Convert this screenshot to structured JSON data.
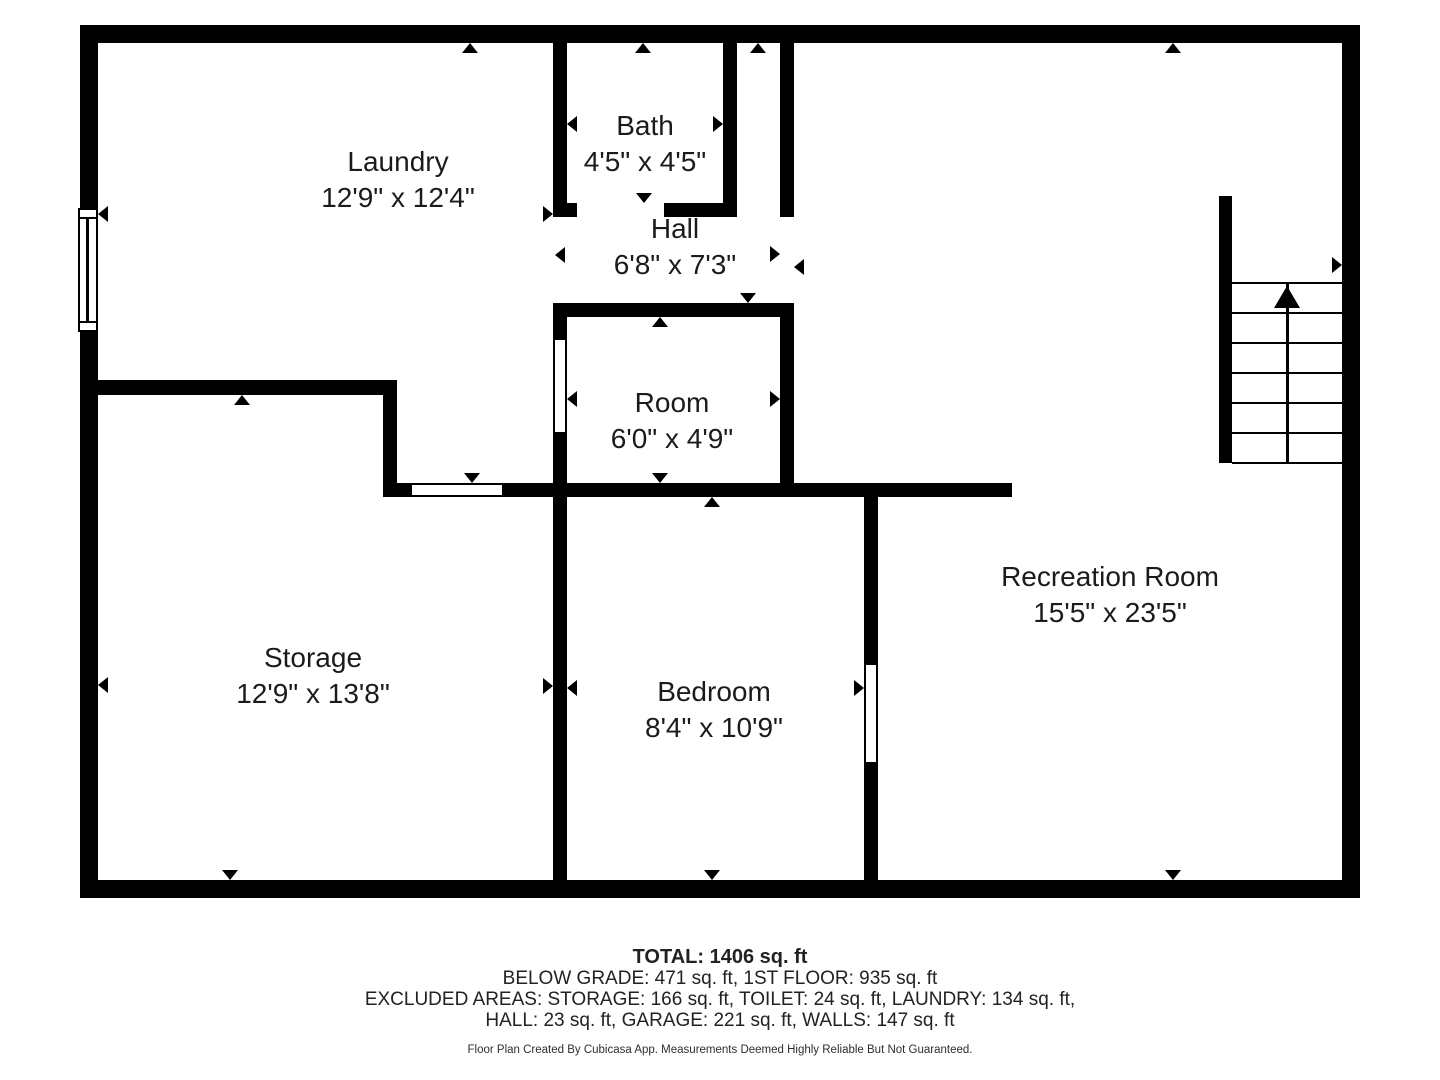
{
  "floorplan": {
    "wall_color": "#000000",
    "rooms": [
      {
        "name": "Laundry",
        "dims": "12'9\" x 12'4\"",
        "cx": 398,
        "cy": 180
      },
      {
        "name": "Bath",
        "dims": "4'5\" x 4'5\"",
        "cx": 645,
        "cy": 144
      },
      {
        "name": "Hall",
        "dims": "6'8\" x 7'3\"",
        "cx": 675,
        "cy": 247
      },
      {
        "name": "Room",
        "dims": "6'0\" x 4'9\"",
        "cx": 672,
        "cy": 421
      },
      {
        "name": "Storage",
        "dims": "12'9\" x 13'8\"",
        "cx": 313,
        "cy": 676
      },
      {
        "name": "Bedroom",
        "dims": "8'4\" x 10'9\"",
        "cx": 714,
        "cy": 710
      },
      {
        "name": "Recreation Room",
        "dims": "15'5\" x 23'5\"",
        "cx": 1110,
        "cy": 595
      }
    ],
    "walls": [
      [
        80,
        25,
        1280,
        18
      ],
      [
        80,
        880,
        1280,
        18
      ],
      [
        80,
        25,
        18,
        183
      ],
      [
        80,
        332,
        18,
        566
      ],
      [
        1342,
        25,
        18,
        873
      ],
      [
        553,
        43,
        14,
        174
      ],
      [
        553,
        203,
        24,
        14
      ],
      [
        664,
        203,
        73,
        14
      ],
      [
        723,
        43,
        14,
        174
      ],
      [
        780,
        43,
        14,
        174
      ],
      [
        553,
        303,
        241,
        14
      ],
      [
        553,
        303,
        14,
        37
      ],
      [
        553,
        432,
        14,
        55
      ],
      [
        780,
        303,
        14,
        194
      ],
      [
        80,
        380,
        317,
        15
      ],
      [
        383,
        380,
        14,
        117
      ],
      [
        383,
        483,
        29,
        14
      ],
      [
        502,
        483,
        510,
        14
      ],
      [
        553,
        483,
        14,
        397
      ],
      [
        864,
        483,
        14,
        182
      ],
      [
        864,
        762,
        14,
        118
      ],
      [
        1219,
        196,
        13,
        267
      ]
    ],
    "doors": [
      {
        "x": 412,
        "y": 483,
        "w": 90,
        "h": 14,
        "edges": "tb"
      },
      {
        "x": 553,
        "y": 340,
        "w": 14,
        "h": 92,
        "edges": "lr"
      },
      {
        "x": 864,
        "y": 665,
        "w": 14,
        "h": 97,
        "edges": "lr"
      }
    ],
    "window": {
      "x": 78,
      "y": 208,
      "w": 20,
      "h": 124,
      "inset": 9
    },
    "stairs": {
      "x": 1232,
      "y": 283,
      "w": 110,
      "h": 180,
      "steps": 6,
      "center_x": 1287
    },
    "arrows": [
      [
        470,
        43,
        "up"
      ],
      [
        643,
        43,
        "up"
      ],
      [
        758,
        43,
        "up"
      ],
      [
        1173,
        43,
        "up"
      ],
      [
        98,
        214,
        "left"
      ],
      [
        553,
        214,
        "right"
      ],
      [
        567,
        124,
        "left"
      ],
      [
        723,
        124,
        "right"
      ],
      [
        644,
        203,
        "down"
      ],
      [
        555,
        255,
        "left"
      ],
      [
        780,
        254,
        "right"
      ],
      [
        794,
        267,
        "left"
      ],
      [
        748,
        303,
        "down"
      ],
      [
        660,
        317,
        "up"
      ],
      [
        567,
        399,
        "left"
      ],
      [
        780,
        399,
        "right"
      ],
      [
        660,
        483,
        "down"
      ],
      [
        472,
        483,
        "down"
      ],
      [
        712,
        497,
        "up"
      ],
      [
        567,
        688,
        "left"
      ],
      [
        553,
        686,
        "right"
      ],
      [
        864,
        688,
        "right"
      ],
      [
        712,
        880,
        "down"
      ],
      [
        98,
        685,
        "left"
      ],
      [
        242,
        395,
        "up"
      ],
      [
        230,
        880,
        "down"
      ],
      [
        1342,
        265,
        "right"
      ],
      [
        1173,
        880,
        "down"
      ]
    ]
  },
  "summary": {
    "total": "TOTAL: 1406 sq. ft",
    "floors": "BELOW GRADE: 471 sq. ft, 1ST FLOOR: 935 sq. ft",
    "excluded1": "EXCLUDED AREAS: STORAGE: 166 sq. ft, TOILET: 24 sq. ft, LAUNDRY: 134 sq. ft,",
    "excluded2": "HALL: 23 sq. ft, GARAGE: 221 sq. ft, WALLS: 147 sq. ft",
    "disclaimer": "Floor Plan Created By Cubicasa App. Measurements Deemed Highly Reliable But Not Guaranteed."
  }
}
